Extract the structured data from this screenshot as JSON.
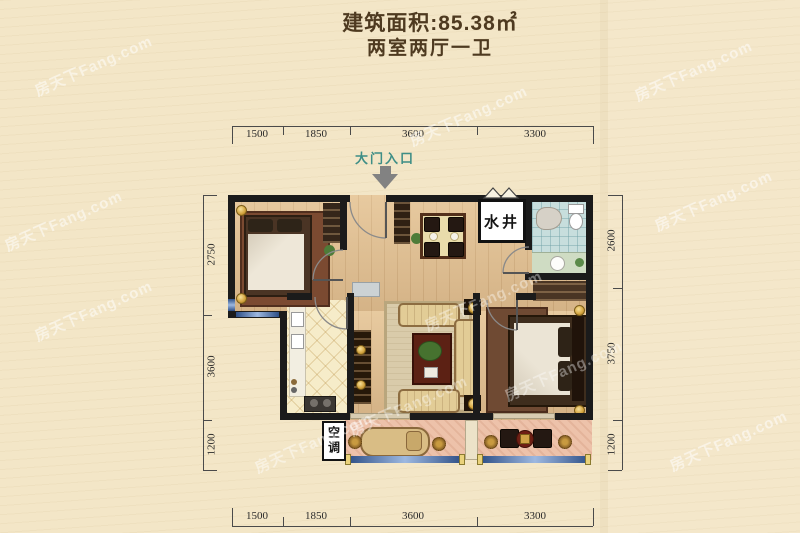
{
  "header": {
    "area": "建筑面积:85.38㎡",
    "rooms": "两室两厅一卫"
  },
  "labels": {
    "entrance": "大门入口",
    "water_well": "水井",
    "air_conditioner": "空调"
  },
  "dims": {
    "top": [
      "1500",
      "1850",
      "3600",
      "3300"
    ],
    "bottom": [
      "1500",
      "1850",
      "3600",
      "3300"
    ],
    "left": [
      "2750",
      "3600",
      "1200"
    ],
    "right": [
      "2600",
      "3750",
      "1200"
    ]
  },
  "watermark": "房天下Fang.com",
  "colors": {
    "background": "#f3e6c7",
    "wall": "#1b1b1b",
    "wood_floor": "#e0bf92",
    "balcony_floor": "#edc2aa",
    "bath_tile": "#c7dedd",
    "window_glass": "#2e4f86",
    "entrance_teal": "#3e8e86",
    "title_brown": "#4e3a20"
  }
}
